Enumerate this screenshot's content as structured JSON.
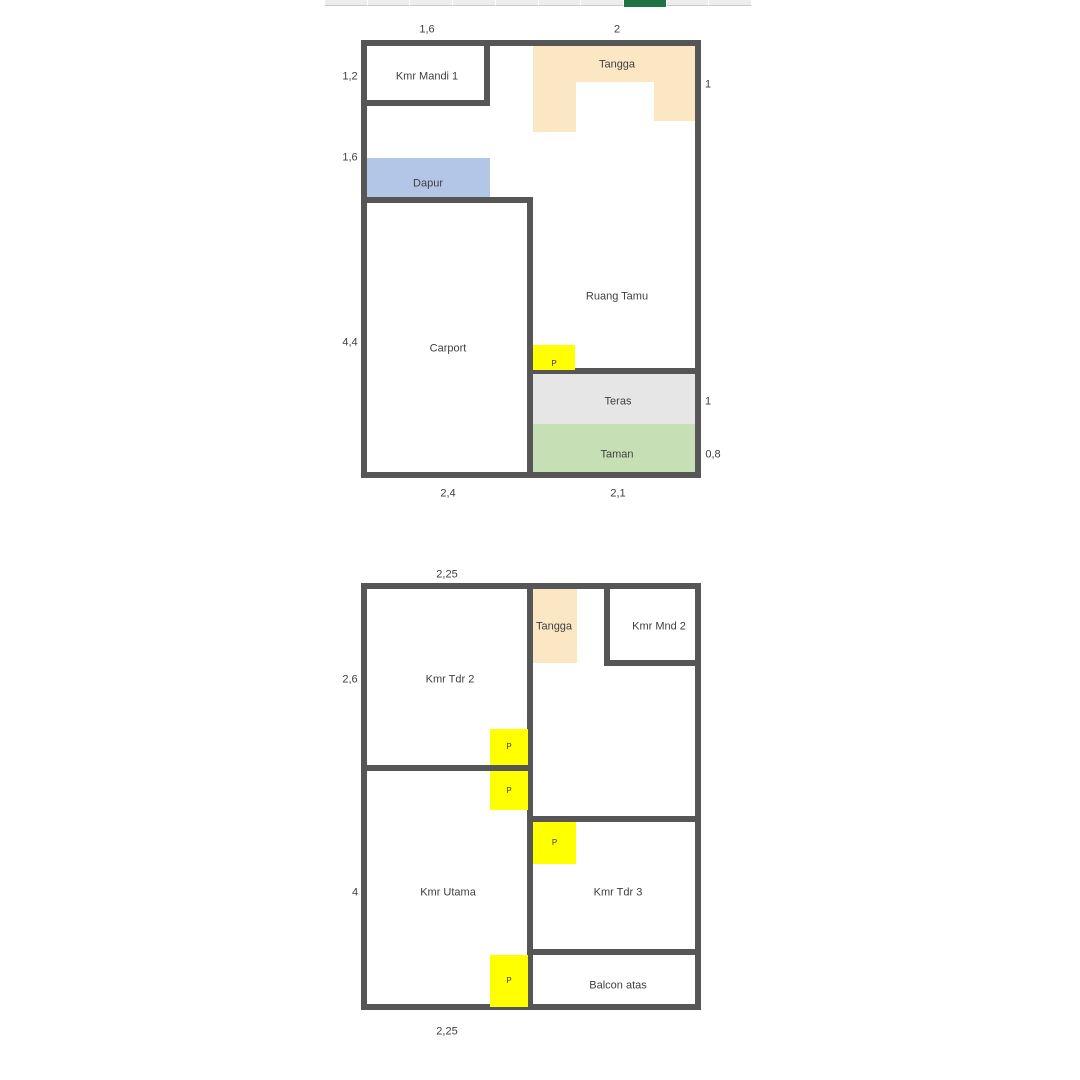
{
  "spreadsheet_strip": {
    "geometry": {
      "x": 325,
      "y": 0,
      "w": 427,
      "h": 6
    },
    "cells": 10,
    "green_cell_index": 7,
    "colors": {
      "cell": "#ededee",
      "separator": "#ffffff",
      "bottom_border": "#c9cbca",
      "green": "#217346"
    }
  },
  "colors": {
    "wall": "#565656",
    "text": "#3f3f3f",
    "door": "#ffff00",
    "stairs": "#fbe7c3",
    "kitchen": "#b4c6e7",
    "terrace": "#e7e6e6",
    "garden": "#c6dfb4"
  },
  "plans": [
    {
      "name": "ground-floor",
      "outline": {
        "x": 361,
        "y": 40,
        "w": 340,
        "h": 438
      },
      "fills": [
        {
          "name": "tangga-top-fill",
          "color_key": "stairs",
          "x": 533,
          "y": 46,
          "w": 163,
          "h": 36
        },
        {
          "name": "tangga-left-leg-fill",
          "color_key": "stairs",
          "x": 533,
          "y": 82,
          "w": 43,
          "h": 50
        },
        {
          "name": "tangga-right-leg-fill",
          "color_key": "stairs",
          "x": 654,
          "y": 82,
          "w": 42,
          "h": 39
        },
        {
          "name": "dapur-fill",
          "color_key": "kitchen",
          "x": 366,
          "y": 158,
          "w": 124,
          "h": 39
        },
        {
          "name": "teras-fill",
          "color_key": "terrace",
          "x": 533,
          "y": 374,
          "w": 163,
          "h": 50
        },
        {
          "name": "taman-fill",
          "color_key": "garden",
          "x": 533,
          "y": 424,
          "w": 163,
          "h": 48
        }
      ],
      "walls": [
        {
          "name": "kmr-mandi-right-wall",
          "x": 484,
          "y": 40,
          "w": 6,
          "h": 66
        },
        {
          "name": "kmr-mandi-bottom-wall",
          "x": 361,
          "y": 100,
          "w": 129,
          "h": 6
        },
        {
          "name": "carport-top-wall",
          "x": 361,
          "y": 197,
          "w": 172,
          "h": 6
        },
        {
          "name": "center-vertical-wall",
          "x": 527,
          "y": 197,
          "w": 6,
          "h": 281
        },
        {
          "name": "teras-top-wall",
          "x": 527,
          "y": 368,
          "w": 174,
          "h": 6
        }
      ],
      "doors": [
        {
          "label": "P",
          "x": 533,
          "y": 345,
          "w": 42,
          "h": 25,
          "label_pos": "bottom"
        }
      ],
      "rooms": [
        {
          "label": "Kmr Mandi 1",
          "cx": 427,
          "cy": 77
        },
        {
          "label": "Tangga",
          "cx": 617,
          "cy": 65
        },
        {
          "label": "Dapur",
          "cx": 428,
          "cy": 184
        },
        {
          "label": "Carport",
          "cx": 448,
          "cy": 349
        },
        {
          "label": "Ruang Tamu",
          "cx": 617,
          "cy": 297
        },
        {
          "label": "Teras",
          "cx": 618,
          "cy": 402
        },
        {
          "label": "Taman",
          "cx": 617,
          "cy": 455
        }
      ],
      "dims": [
        {
          "text": "1,6",
          "cx": 427,
          "cy": 30
        },
        {
          "text": "2",
          "cx": 617,
          "cy": 30
        },
        {
          "text": "1,2",
          "cx": 350,
          "cy": 77
        },
        {
          "text": "1",
          "cx": 708,
          "cy": 85
        },
        {
          "text": "1,6",
          "cx": 350,
          "cy": 158
        },
        {
          "text": "4,4",
          "cx": 350,
          "cy": 343
        },
        {
          "text": "1",
          "cx": 708,
          "cy": 402
        },
        {
          "text": "0,8",
          "cx": 713,
          "cy": 455
        },
        {
          "text": "2,4",
          "cx": 448,
          "cy": 494
        },
        {
          "text": "2,1",
          "cx": 618,
          "cy": 494
        }
      ]
    },
    {
      "name": "upper-floor",
      "outline": {
        "x": 361,
        "y": 583,
        "w": 340,
        "h": 427
      },
      "fills": [
        {
          "name": "tangga-upper-fill",
          "color_key": "stairs",
          "x": 533,
          "y": 589,
          "w": 44,
          "h": 74
        }
      ],
      "walls": [
        {
          "name": "center-vertical-wall",
          "x": 527,
          "y": 583,
          "w": 6,
          "h": 427
        },
        {
          "name": "kmr-tdr2-bottom-wall",
          "x": 361,
          "y": 765,
          "w": 172,
          "h": 6
        },
        {
          "name": "kmr-mnd2-left-wall",
          "x": 604,
          "y": 583,
          "w": 6,
          "h": 83
        },
        {
          "name": "kmr-mnd2-bottom-wall",
          "x": 604,
          "y": 660,
          "w": 97,
          "h": 6
        },
        {
          "name": "kmr-tdr3-top-wall",
          "x": 527,
          "y": 816,
          "w": 174,
          "h": 6
        },
        {
          "name": "kmr-tdr3-bottom-wall",
          "x": 527,
          "y": 949,
          "w": 174,
          "h": 6
        }
      ],
      "doors": [
        {
          "label": "P",
          "x": 490,
          "y": 729,
          "w": 38,
          "h": 36,
          "label_pos": "center"
        },
        {
          "label": "P",
          "x": 490,
          "y": 771,
          "w": 38,
          "h": 39,
          "label_pos": "center"
        },
        {
          "label": "P",
          "x": 533,
          "y": 822,
          "w": 43,
          "h": 42,
          "label_pos": "center"
        },
        {
          "label": "P",
          "x": 490,
          "y": 955,
          "w": 38,
          "h": 52,
          "label_pos": "center"
        }
      ],
      "rooms": [
        {
          "label": "Kmr Tdr 2",
          "cx": 450,
          "cy": 680
        },
        {
          "label": "Tangga",
          "cx": 554,
          "cy": 627
        },
        {
          "label": "Kmr Mnd 2",
          "cx": 659,
          "cy": 627
        },
        {
          "label": "Kmr Utama",
          "cx": 448,
          "cy": 893
        },
        {
          "label": "Kmr Tdr 3",
          "cx": 618,
          "cy": 893
        },
        {
          "label": "Balcon atas",
          "cx": 618,
          "cy": 986
        }
      ],
      "dims": [
        {
          "text": "2,25",
          "cx": 447,
          "cy": 575
        },
        {
          "text": "2,6",
          "cx": 350,
          "cy": 680
        },
        {
          "text": "4",
          "cx": 355,
          "cy": 893
        },
        {
          "text": "2,25",
          "cx": 447,
          "cy": 1032
        }
      ]
    }
  ]
}
